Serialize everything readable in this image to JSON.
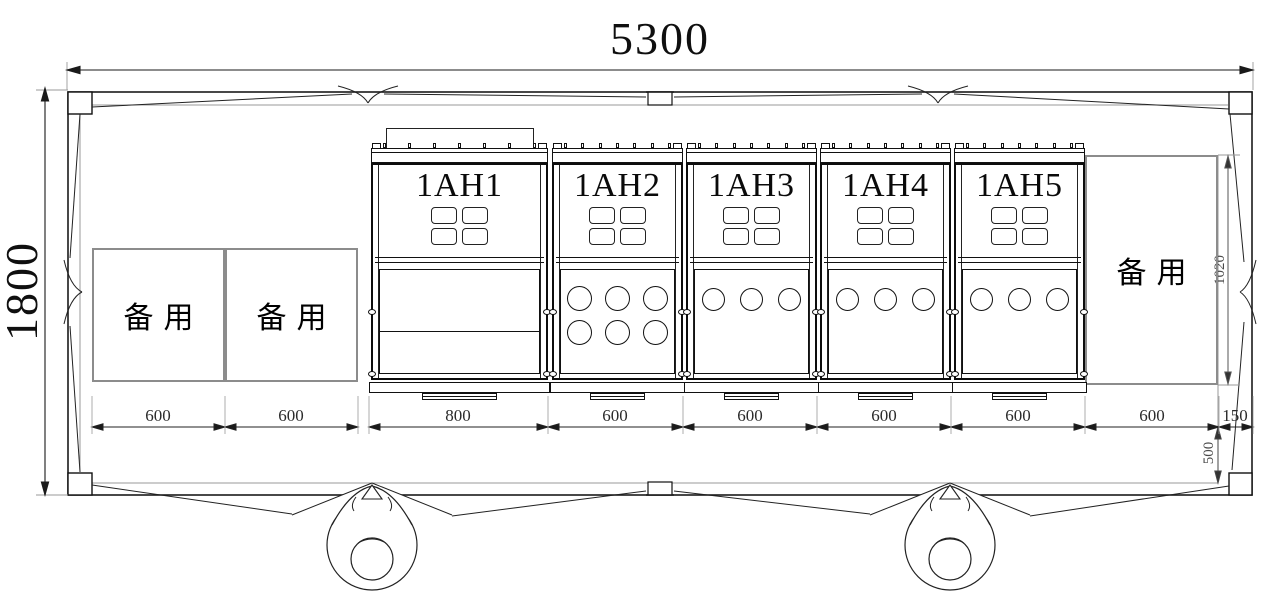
{
  "drawing": {
    "type": "switchgear-room-floor-plan",
    "dimensions": {
      "overall_width": "5300",
      "overall_height": "1800",
      "bottom": [
        "600",
        "600",
        "800",
        "600",
        "600",
        "600",
        "600",
        "600",
        "150"
      ],
      "cabinet_depth": "1020",
      "rear_clearance": "500"
    },
    "cabinets": [
      {
        "label": "1AH1"
      },
      {
        "label": "1AH2"
      },
      {
        "label": "1AH3"
      },
      {
        "label": "1AH4"
      },
      {
        "label": "1AH5"
      }
    ],
    "spares": [
      {
        "label": "备用"
      },
      {
        "label": "备用"
      },
      {
        "label": "备用"
      }
    ],
    "colors": {
      "line": "#1a1a1a",
      "secondary": "#8c8c8c",
      "background": "#ffffff"
    }
  }
}
